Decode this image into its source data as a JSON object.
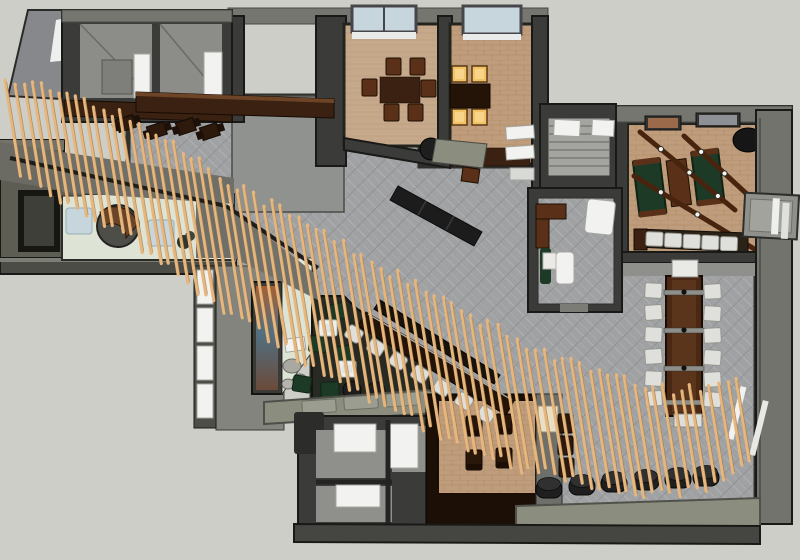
{
  "meta": {
    "title": "overhead-3d-floor-plan-render",
    "canvas_width": 800,
    "canvas_height": 560,
    "style": "sketchup-top-view-interior"
  },
  "regions": [
    "entry",
    "reception",
    "art-lounge",
    "main-dining-hall",
    "kitchen",
    "private-dining-room-1",
    "private-dining-room-2",
    "games-room",
    "meeting-room",
    "communal-table",
    "sushi-bar",
    "games-bar",
    "restrooms",
    "booth-nook",
    "window-bench",
    "slat-ribbon-feature"
  ],
  "palette": {
    "canvas": "#cdcec8",
    "wallTop": "#75766f",
    "wallMid": "#8c8d89",
    "wallDark": "#3b3b39",
    "outline": "#191917",
    "olive": "#5d5d53",
    "roomGray": "#8f908b",
    "carpet": "#a0a1a3",
    "carpetLight": "#aeafb1",
    "carpetDark": "#919295",
    "kitchen": "#90928f",
    "floorTan": "#c6a98b",
    "floorBrick": "#bf9d7c",
    "brickLine": "#a5815c",
    "floorMint": "#dde4d6",
    "floorDark": "#262a23",
    "woodDark": "#3a2112",
    "woodMid": "#5a3118",
    "woodDeep": "#241307",
    "slat": "#e6b67c",
    "slatEdge": "#8f6a3d",
    "green": "#1d3a26",
    "white": "#f2f2f0",
    "chair": "#dfdfdc",
    "glass": "#c7d6dd",
    "amber": "#f1c364",
    "black": "#1e1e1e",
    "oliveBench": "#8b8d7e",
    "artOrange": "#a65f33",
    "artBlue": "#517082",
    "stone": "#a9a9a2"
  },
  "slat_ribbon": {
    "count": 82,
    "x0": 14,
    "spacing": 9,
    "width": 3.2,
    "lean": 0.16,
    "path": [
      [
        14,
        128,
        92
      ],
      [
        40,
        138,
        108
      ],
      [
        80,
        156,
        118
      ],
      [
        120,
        174,
        128
      ],
      [
        160,
        200,
        140
      ],
      [
        200,
        228,
        148
      ],
      [
        240,
        254,
        150
      ],
      [
        280,
        278,
        152
      ],
      [
        320,
        301,
        152
      ],
      [
        360,
        323,
        152
      ],
      [
        400,
        345,
        150
      ],
      [
        440,
        366,
        146
      ],
      [
        480,
        386,
        140
      ],
      [
        520,
        403,
        134
      ],
      [
        560,
        417,
        126
      ],
      [
        600,
        429,
        118
      ],
      [
        640,
        438,
        110
      ],
      [
        680,
        441,
        102
      ],
      [
        710,
        436,
        94
      ],
      [
        744,
        419,
        86
      ]
    ]
  },
  "furniture": {
    "communal_chair_rows": [
      283,
      305,
      327,
      349,
      371,
      391
    ],
    "bar_stools": {
      "x0": 354,
      "y0": 334,
      "dx": 22,
      "dy": 13.4,
      "count": 7
    },
    "games_stools": {
      "x0": 646,
      "y0": 232,
      "dx": 18.6,
      "dy": 1.2,
      "count": 5
    },
    "floor_stools": [
      [
        549,
        489
      ],
      [
        582,
        486
      ],
      [
        614,
        483
      ],
      [
        646,
        481
      ],
      [
        678,
        479
      ],
      [
        706,
        477
      ]
    ],
    "cushions": [
      [
        336,
        312
      ],
      [
        318,
        344
      ],
      [
        344,
        354
      ],
      [
        302,
        384
      ],
      [
        330,
        390
      ],
      [
        303,
        416
      ],
      [
        338,
        417
      ]
    ],
    "poufs": [
      [
        352,
        390
      ],
      [
        376,
        391
      ],
      [
        396,
        401
      ]
    ],
    "lounge_tables": [
      [
        328,
        328
      ],
      [
        347,
        369
      ]
    ],
    "room1_chairs": [
      [
        386,
        58
      ],
      [
        410,
        58
      ],
      [
        384,
        104
      ],
      [
        408,
        104
      ],
      [
        362,
        79
      ],
      [
        421,
        80
      ]
    ],
    "room2_chairs": [
      [
        452,
        66
      ],
      [
        472,
        66
      ],
      [
        452,
        109
      ],
      [
        472,
        109
      ]
    ],
    "small_dining": [
      [
        126,
        124
      ],
      [
        157,
        131
      ],
      [
        186,
        127
      ],
      [
        210,
        132
      ]
    ],
    "beams": [
      [
        640,
        132,
        735,
        210
      ],
      [
        684,
        136,
        762,
        208
      ],
      [
        634,
        176,
        756,
        250
      ]
    ],
    "bench_seats": [
      [
        302,
        400
      ],
      [
        344,
        396
      ],
      [
        386,
        393
      ]
    ],
    "booth_chairs": [
      [
        466,
        416
      ],
      [
        496,
        414
      ],
      [
        466,
        450
      ],
      [
        496,
        448
      ]
    ],
    "wall_seats": [
      [
        558,
        414
      ],
      [
        558,
        436
      ],
      [
        559,
        458
      ]
    ]
  }
}
